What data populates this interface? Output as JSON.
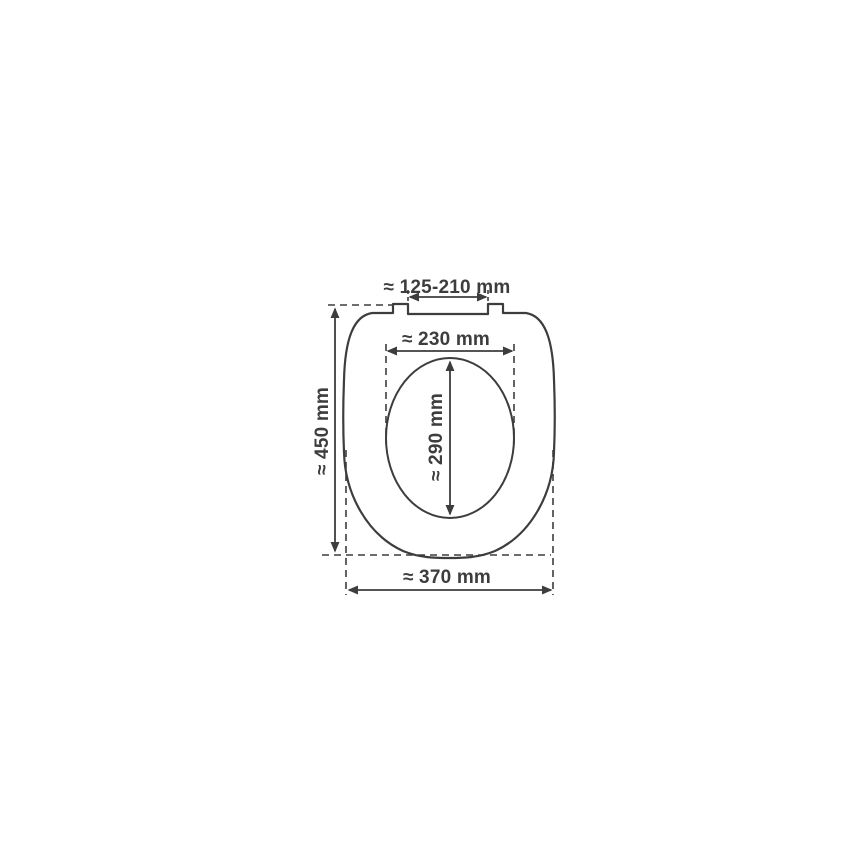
{
  "diagram": {
    "subject": "toilet-seat-dimension-drawing",
    "background_color": "#ffffff",
    "line_color": "#3d3d3d",
    "text_color": "#3d3d3d",
    "unit": "mm",
    "labels": {
      "hinge_distance": "≈ 125-210 mm",
      "inner_width": "≈ 230 mm",
      "inner_length": "≈ 290 mm",
      "overall_length": "≈ 450 mm",
      "overall_width": "≈ 370 mm"
    }
  }
}
